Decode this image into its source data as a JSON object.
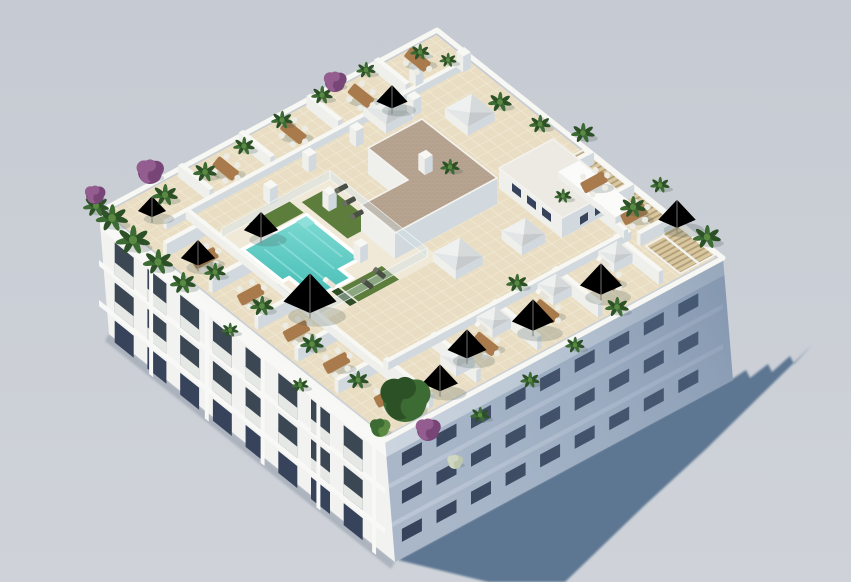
{
  "meta": {
    "title": "Apartment building rooftop – aerial 3D render",
    "alt": "Aerial isometric 3D architectural render of a white apartment building with a landscaped rooftop terrace: communal swimming pool with turf sunbathing lawns, private tiled terraces with beige parasols, dining sets and potted palms, skylight boxes, a gravel-roofed stair core, wood pergola slats along one edge, and a long blue-gray shadow cast to the lower right on a plain light gray background."
  },
  "scene": {
    "type": "3d-architectural-render",
    "view": "isometric aerial from above the south-west corner",
    "background": "plain light gray, no horizon",
    "lighting": {
      "sun_direction": "upper-left",
      "cast_shadow": "long blue-gray shadow toward lower right with stepped silhouette edge"
    },
    "building": {
      "kind": "white residential apartment block",
      "floors_visible": 3,
      "left_facade": "bright white with recessed balconies and dark window openings",
      "right_facade": "in shade, blue-gray with small dark window slots",
      "roof": "communal rooftop terrace with beige tiled deck"
    },
    "rooftop_features": [
      "T-shaped turquoise swimming pool with white kerb",
      "artificial turf sunbathing lawns with loungers",
      "glass pool balustrade",
      "L-shaped stair/elevator core with brown gravel roof",
      "white annex volume with small dark windows",
      "white skylight boxes and a long skylight trough",
      "private terraces divided by low white walls",
      "beige and white pyramid parasols",
      "wooden dining tables with white chairs",
      "potted palms, shrubs and purple bougainvillea",
      "wood pergola slats along the north-east edge",
      "white chimney pillars"
    ],
    "counts": {
      "parasols": 10,
      "dining_tables": 12,
      "skylight_boxes": 8,
      "sun_loungers": 7,
      "private_terraces": 16,
      "chimney_pillars": 9
    }
  },
  "colors": {
    "sky_top": "#c6cad2",
    "sky_bottom": "#cfd3d9",
    "cast_shadow": "#54708d",
    "facade_light": "#f2f3f1",
    "facade_light_band": "#f8f8f6",
    "facade_se": "#a9b7c9",
    "facade_se_band": "#bac5d5",
    "facade_se_parapet": "#ccd5df",
    "window_dark": "#36435a",
    "window_opening": "#3c4754",
    "glass": "#93a5b4",
    "railing": "#eff1ee",
    "parapet": "#f7f7f4",
    "wall_top": "#f7f7f4",
    "wall_se": "#d2d9de",
    "wall_sw": "#efefec",
    "roof_tile": "#e9dec3",
    "tile_line": "#f3ebd8",
    "deck": "#f1e9d7",
    "pool_light": "#7edad2",
    "pool_deep": "#43bcb5",
    "pool_edge": "#ffffff",
    "turf": "#5c7d3c",
    "hedge": "#2f4d27",
    "gravel": "#b6a390",
    "gravel_dot": "#a6917d",
    "annex_roof": "#edeae3",
    "pergola": "#d9c79f",
    "pergola_gap": "#b3a07b",
    "plant": "#3c6b33",
    "plant_dark": "#2c5126",
    "plant_light": "#5a8a42",
    "bougainvillea": "#935d90",
    "bougainvillea_dark": "#774677",
    "wood": "#a87a4c",
    "chair": "#ecebe4",
    "lounger": "#e7e3d8",
    "cushion": "#4a4f46",
    "glass_fence": "rgba(208,224,228,0.42)",
    "fence_frame": "rgba(250,252,252,0.85)",
    "item_shadow": "rgba(70,85,80,0.22)"
  }
}
